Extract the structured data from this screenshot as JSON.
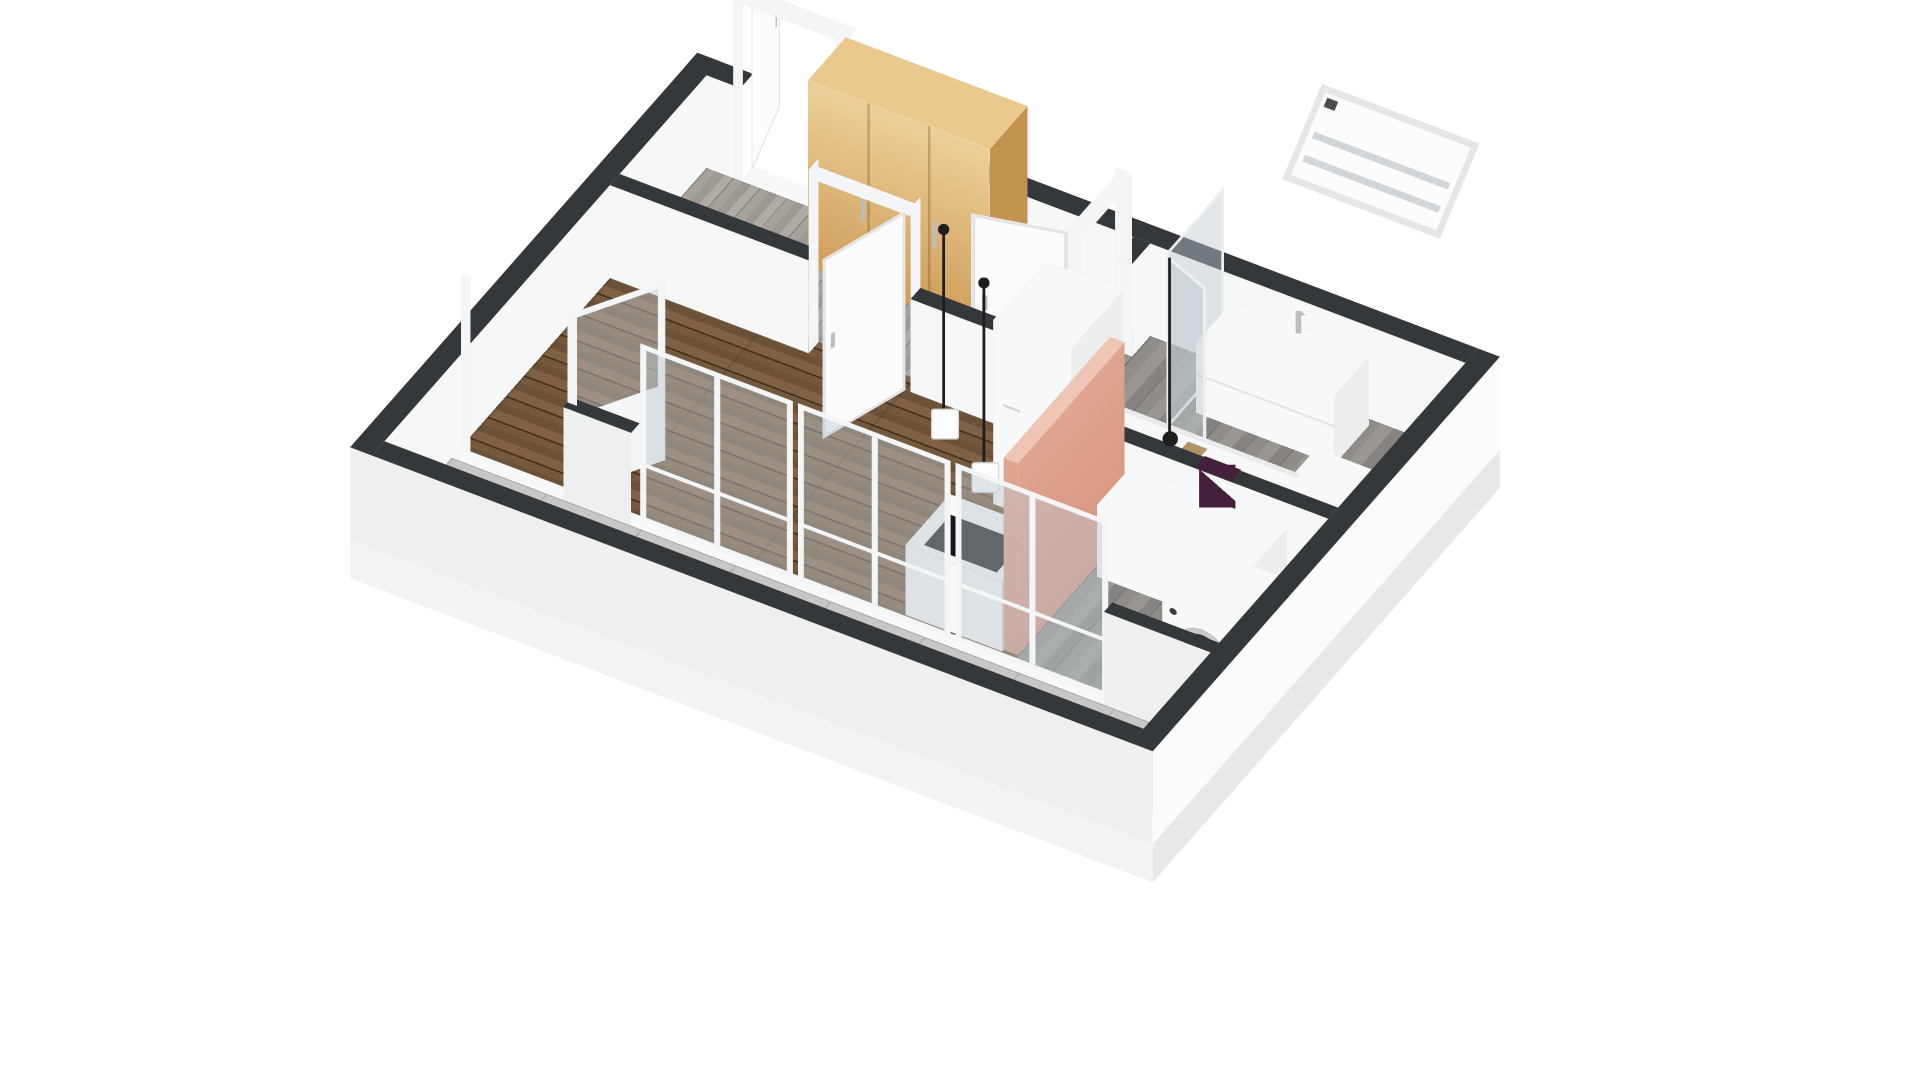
{
  "meta": {
    "description": "3D perspective floor plan rendering of a studio apartment with balcony, no visible text labels",
    "view": "isometric-style 3d floorplan, walls cut low, white background",
    "background": "#ffffff"
  },
  "palette": {
    "bg": "#ffffff",
    "wall_top": "#35383b",
    "wall_int": "#f6f7f7",
    "wall_out_front": "#eef0f0",
    "wall_out_right": "#fafbfb",
    "wall_out_left": "#e8eaea",
    "slab_front": "#f2f3f4",
    "slab_right": "#e6e8e9",
    "wood_1": "#75593d",
    "wood_2": "#6b5138",
    "wood_3": "#7f6245",
    "wood_line": "#46331f",
    "hall_1": "#a7a29c",
    "hall_2": "#9d9892",
    "hall_3": "#b0aba5",
    "hall_line": "#8a857f",
    "bath_1": "#908d89",
    "bath_2": "#9a9793",
    "bath_3": "#868380",
    "bath_line": "#787571",
    "balcony_1": "#c8c7c5",
    "balcony_line": "#b3b2b0",
    "frame": "#f4f5f6",
    "door": "#fcfcfd",
    "door_edge": "#e2e4e5",
    "glass": "rgba(188,199,207,0.45)",
    "oak": "#cf9d58",
    "oak_light": "#ecd09a",
    "oak_side": "#c3924e",
    "oak_top": "#e9c98d",
    "pink": "#e0a492",
    "pink_dark": "#d5947f",
    "pink_top": "#efc6b5",
    "appliance": "#f7f8f8",
    "appliance_side": "#ededee",
    "cooktop": "#17171b",
    "towel": "#44203c",
    "lamp": "#1e1e20",
    "steel": "#b9bdbf",
    "drum": "#2a2326"
  },
  "scene": {
    "rooms": [
      {
        "name": "living-room",
        "floor": "dark walnut wood planks"
      },
      {
        "name": "entrance-hall",
        "floor": "grey wood-look planks"
      },
      {
        "name": "bathroom",
        "floor": "grey tile planks"
      },
      {
        "name": "kitchen-laundry-nook",
        "floor": "grey tile planks"
      },
      {
        "name": "balcony",
        "floor": "large light-grey tiles"
      }
    ],
    "objects": [
      "entrance-door-open",
      "oak-wardrobe",
      "interior-door-living-open",
      "interior-door-bathroom-open",
      "shower-glass-enclosure",
      "bathroom-vanity-with-faucet",
      "floating-mirror-cabinet",
      "bathtub",
      "purple-towel",
      "toilet",
      "washing-machine",
      "pink-feature-wall",
      "kitchen-counter-with-cooktop",
      "kitchen-nook-counter",
      "tall-white-cabinet",
      "pendant-lamp-shade",
      "pendant-lamp-shade-2",
      "pendant-lamp-bare",
      "balcony-glass-door-open",
      "window-wall-three-bays",
      "balcony-parapet"
    ]
  }
}
